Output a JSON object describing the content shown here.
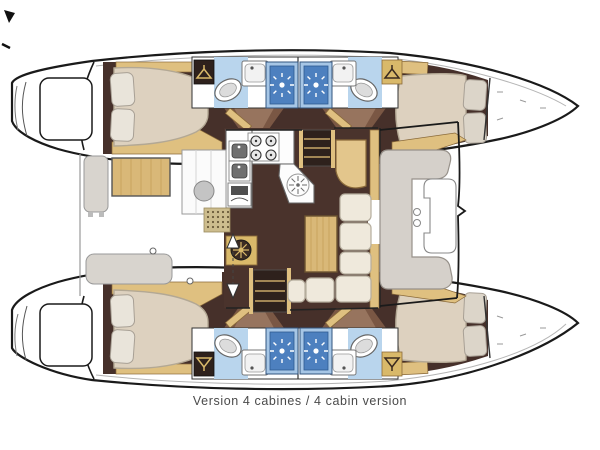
{
  "diagram": {
    "type": "catamaran-floor-plan",
    "caption": "Version 4 cabines / 4 cabin version",
    "orientation": {
      "bow": "right",
      "stern": "left"
    },
    "upper_hull": {
      "aft_cabin": {
        "berth": "double",
        "pillows": 2,
        "wardrobe": true
      },
      "forward_cabin": {
        "berth": "double",
        "pillows": 2,
        "wardrobe": true
      },
      "bathrooms": [
        {
          "fixtures": [
            "toilet",
            "washbasin",
            "shower"
          ]
        },
        {
          "fixtures": [
            "shower",
            "washbasin",
            "toilet"
          ]
        }
      ],
      "stern": "swim-platform-with-steps"
    },
    "lower_hull": {
      "aft_cabin": {
        "berth": "double",
        "pillows": 2,
        "wardrobe": true
      },
      "forward_cabin": {
        "berth": "double",
        "pillows": 2,
        "wardrobe": true
      },
      "bathrooms": [
        {
          "fixtures": [
            "toilet",
            "washbasin",
            "shower"
          ]
        },
        {
          "fixtures": [
            "shower",
            "washbasin",
            "toilet"
          ]
        }
      ],
      "stern": "swim-platform-with-steps"
    },
    "saloon": {
      "galley": [
        "stove-4-burners",
        "double-sink",
        "fridge",
        "round-sink",
        "angled-counter"
      ],
      "dinette": [
        "wood-table",
        "l-shaped-sofa"
      ],
      "nav_desk": true,
      "companionway_stairs": 2,
      "entry_arrows": [
        "arrow-up",
        "arrow-down"
      ],
      "helm_wheel_locker": true
    },
    "aft_cockpit": [
      "wood-table",
      "side-bench",
      "aft-bench",
      "wet-bar-with-sink",
      "dotted-mat"
    ],
    "forward_cockpit": [
      "c-shaped-bench",
      "table",
      "cup-holders"
    ],
    "icons": [
      "shower-sunburst-icon",
      "toilet-icon",
      "washbasin-icon",
      "hanger-icon",
      "stove-burner-icon",
      "helm-wheel-icon",
      "stairs-icon",
      "arrow-up-icon",
      "arrow-down-icon",
      "fridge-icon"
    ],
    "colors": {
      "outline": "#1a1a1a",
      "floor_brown": "#46302a",
      "door_brown": "#7a5744",
      "wood_trim": "#dfc080",
      "wood_table": "#d9b878",
      "locker_tan": "#d9b96a",
      "mattress_cream": "#ddd1bf",
      "sofa_cream": "#efe9dc",
      "bench_gray": "#d5d0ca",
      "shower_blue": "#4d80bf",
      "shower_frame": "#a6c6e6",
      "bath_floor_blue": "#b9d5ed",
      "caption_gray": "#4a4a4a"
    }
  }
}
